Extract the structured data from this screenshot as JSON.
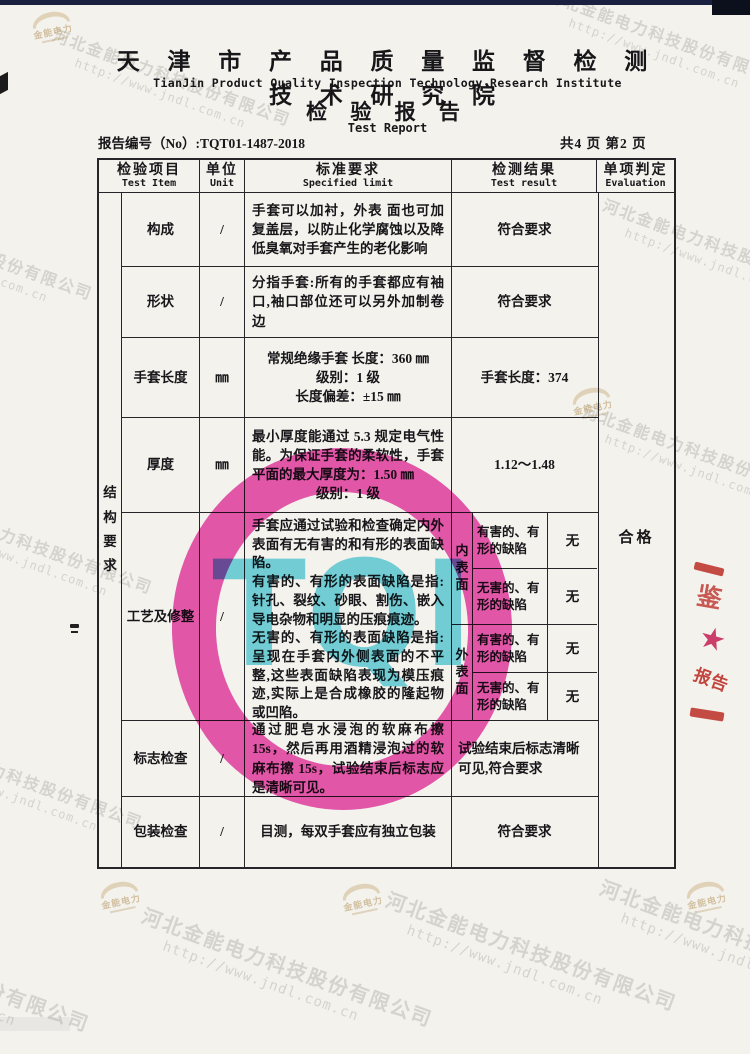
{
  "header": {
    "institute_cn": "天 津 市 产 品 质 量 监 督 检 测 技 术 研 究 院",
    "institute_en": "TianJin Product Quality Inspection Technology Research Institute",
    "title_cn": "检 验 报 告",
    "title_en": "Test Report",
    "report_no": "报告编号（No）:TQT01-1487-2018",
    "pages": "共4 页  第2 页"
  },
  "table": {
    "col_headers": [
      {
        "cn": "检验项目",
        "en": "Test Item"
      },
      {
        "cn": "单位",
        "en": "Unit"
      },
      {
        "cn": "标准要求",
        "en": "Specified limit"
      },
      {
        "cn": "检测结果",
        "en": "Test result"
      },
      {
        "cn": "单项判定",
        "en": "Evaluation"
      }
    ],
    "group_label": "结构要求",
    "evaluation": "合格",
    "rows": [
      {
        "item": "构成",
        "unit": "/",
        "spec": "手套可以加衬，外表 面也可加复盖层，以防止化学腐蚀以及降低臭氧对手套产生的老化影响",
        "result": "符合要求"
      },
      {
        "item": "形状",
        "unit": "/",
        "spec": "分指手套:所有的手套都应有袖口,袖口部位还可以另外加制卷边",
        "result": "符合要求"
      },
      {
        "item": "手套长度",
        "unit": "㎜",
        "spec_lines": [
          "常规绝缘手套 长度：360 ㎜",
          "级别：1 级",
          "长度偏差：±15 ㎜"
        ],
        "result": "手套长度：374"
      },
      {
        "item": "厚度",
        "unit": "㎜",
        "spec": "最小厚度能通过 5.3 规定电气性能。为保证手套的柔软性，手套平面的最大厚度为：1.50 ㎜",
        "spec_line2": "级别：1 级",
        "result": "1.12～1.48"
      },
      {
        "item": "工艺及修整",
        "unit": "/",
        "spec_paras": [
          "手套应通过试验和检查确定内外表面有无有害的和有形的表面缺陷。",
          "有害的、有形的表面缺陷是指:针孔、裂纹、砂眼、割伤、嵌入导电杂物和明显的压痕痕迹。",
          "无害的、有形的表面缺陷是指:呈现在手套内外侧表面的不平整,这些表面缺陷表现为模压痕迹,实际上是合成橡胶的隆起物或凹陷。"
        ],
        "result_sections": [
          {
            "label": "内表面",
            "entries": [
              {
                "defect": "有害的、有形的缺陷",
                "value": "无"
              },
              {
                "defect": "无害的、有形的缺陷",
                "value": "无"
              }
            ]
          },
          {
            "label": "外表面",
            "entries": [
              {
                "defect": "有害的、有形的缺陷",
                "value": "无"
              },
              {
                "defect": "无害的、有形的缺陷",
                "value": "无"
              }
            ]
          }
        ]
      },
      {
        "item": "标志检查",
        "unit": "/",
        "spec": "通过肥皂水浸泡的软麻布擦15s，然后再用酒精浸泡过的软麻布擦 15s，试验结束后标志应是清晰可见。",
        "result": "试验结束后标志清晰可见,符合要求"
      },
      {
        "item": "包装检查",
        "unit": "/",
        "spec": "目测，每双手套应有独立包装",
        "result": "符合要求"
      }
    ]
  },
  "stamps": {
    "tqi_letters": "TQI",
    "seal_char": "鉴",
    "seal_star": "★",
    "seal_text": "报告"
  },
  "watermark": {
    "company": "河北金能电力科技股份有限公司",
    "url": "http://www.jndl.com.cn",
    "logo_text": "金能电力"
  },
  "colors": {
    "stamp_magenta": "#e72399",
    "stamp_cyan": "#35c4d6",
    "seal_red": "#c32820",
    "watermark_gray": "#94928a",
    "logo_gold": "#d0b88c"
  }
}
